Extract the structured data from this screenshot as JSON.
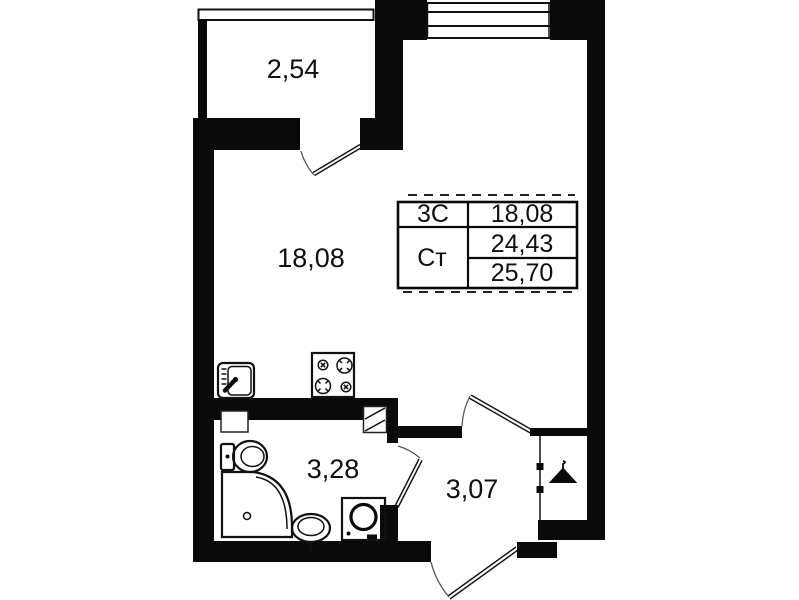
{
  "plan": {
    "type": "apartment-floor-plan",
    "colors": {
      "wall": "#0a0a0a",
      "background": "#ffffff",
      "line": "#111111",
      "arc": "#555555"
    },
    "labels": {
      "balcony": "2,54",
      "living_room": "18,08",
      "bathroom": "3,28",
      "hallway": "3,07"
    },
    "stamp": {
      "rows": [
        {
          "label": "3С",
          "value": "18,08"
        },
        {
          "label": "Ст",
          "value": "24,43"
        },
        {
          "label": "",
          "value": "25,70"
        }
      ]
    },
    "icons": {
      "kitchen-sink-icon": "rounded square with faucet",
      "stove-icon": "4-burner cooktop",
      "toilet-icon": "tank + oval bowl",
      "shower-tray-icon": "square tray with rounded corner and drain",
      "washbasin-icon": "oval basin on pedestal",
      "washing-machine-icon": "square with porthole door",
      "hanger-icon": "coat hanger triangle",
      "vent-shaft-icon": "hatched box",
      "window-icon": "parallel glazing lines",
      "door-arc-icon": "door leaf with swing arc"
    }
  }
}
